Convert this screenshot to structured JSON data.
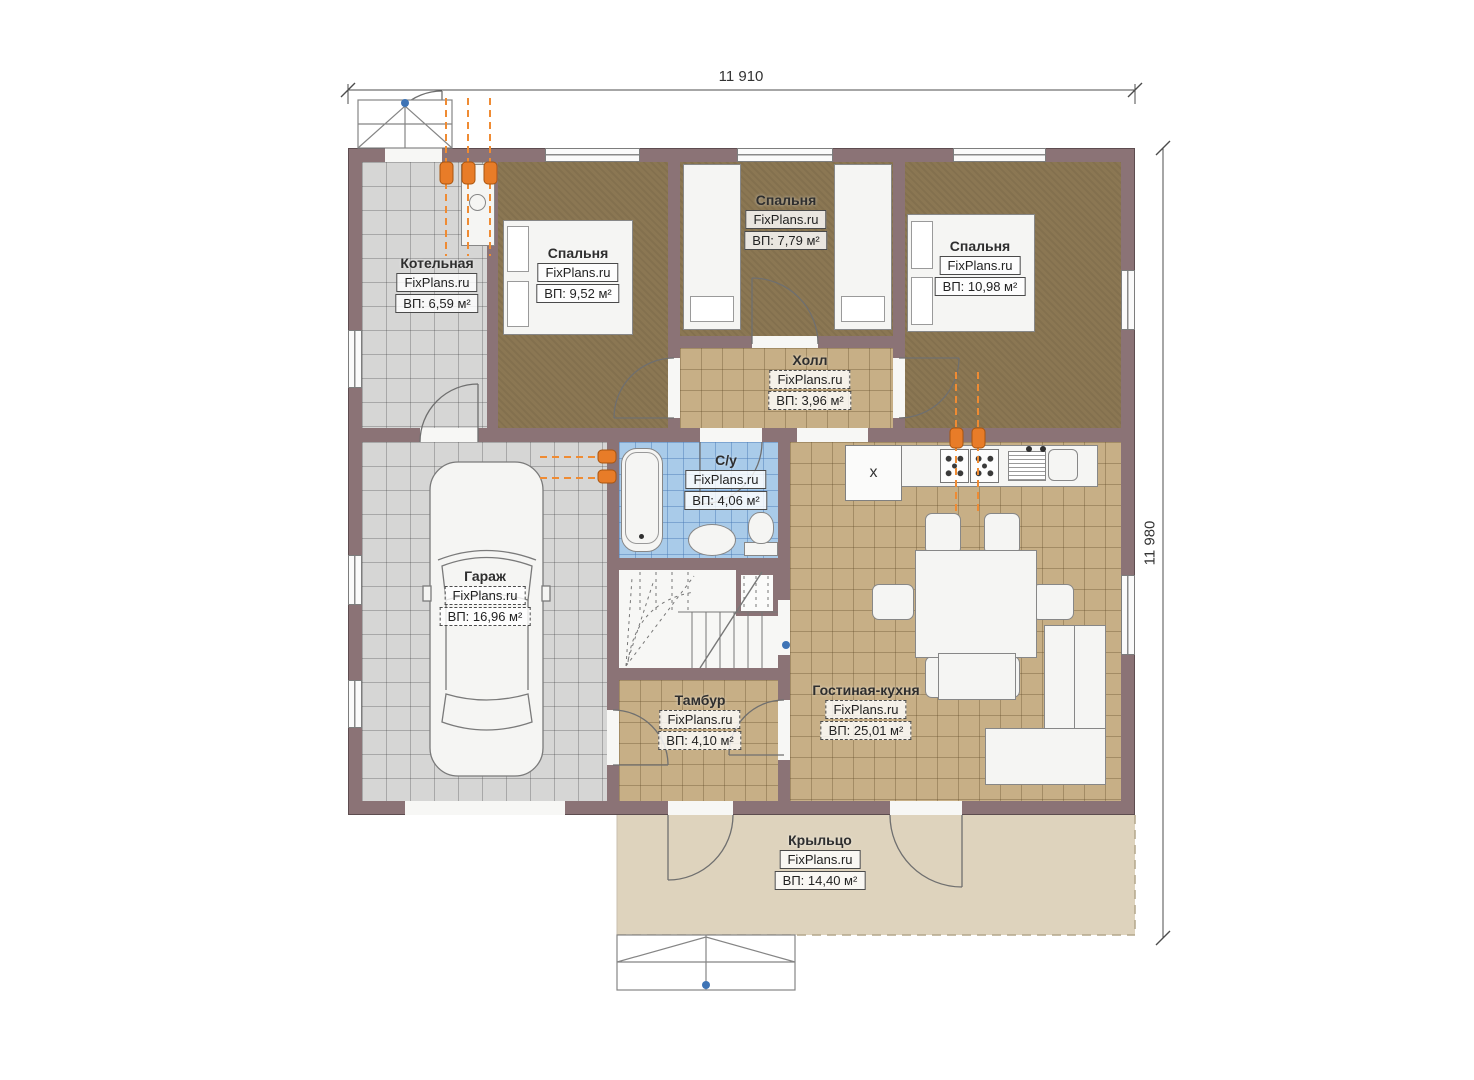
{
  "plan": {
    "watermark": "FixPlans.ru",
    "dimensions": {
      "width_label": "11 910",
      "height_label": "11 980"
    },
    "rooms": [
      {
        "key": "boiler",
        "name": "Котельная",
        "area": "ВП: 6,59 м²"
      },
      {
        "key": "bedroom1",
        "name": "Спальня",
        "area": "ВП: 9,52 м²"
      },
      {
        "key": "bedroom2",
        "name": "Спальня",
        "area": "ВП: 7,79 м²"
      },
      {
        "key": "bedroom3",
        "name": "Спальня",
        "area": "ВП: 10,98 м²"
      },
      {
        "key": "hall",
        "name": "Холл",
        "area": "ВП: 3,96 м²"
      },
      {
        "key": "bathroom",
        "name": "С/у",
        "area": "ВП: 4,06 м²"
      },
      {
        "key": "garage",
        "name": "Гараж",
        "area": "ВП: 16,96 м²"
      },
      {
        "key": "vestibule",
        "name": "Тамбур",
        "area": "ВП: 4,10 м²"
      },
      {
        "key": "living_kitchen",
        "name": "Гостиная-кухня",
        "area": "ВП: 25,01 м²"
      },
      {
        "key": "porch",
        "name": "Крыльцо",
        "area": "ВП: 14,40 м²"
      }
    ],
    "kitchen": {
      "fridge_symbol": "x"
    },
    "icons": {
      "radiator": "orange heating riser marker",
      "stove_burner": "gas burner cross",
      "direction_dot": "blue reference point"
    },
    "colors": {
      "wall": "#8b7376",
      "bedroom_floor": "#8b7753",
      "tile_tan": "#c7af86",
      "tile_gray": "#d6d6d5",
      "tile_blue": "#a9cbe9",
      "porch": "#ded3bd",
      "radiator": "#e87c28"
    }
  }
}
